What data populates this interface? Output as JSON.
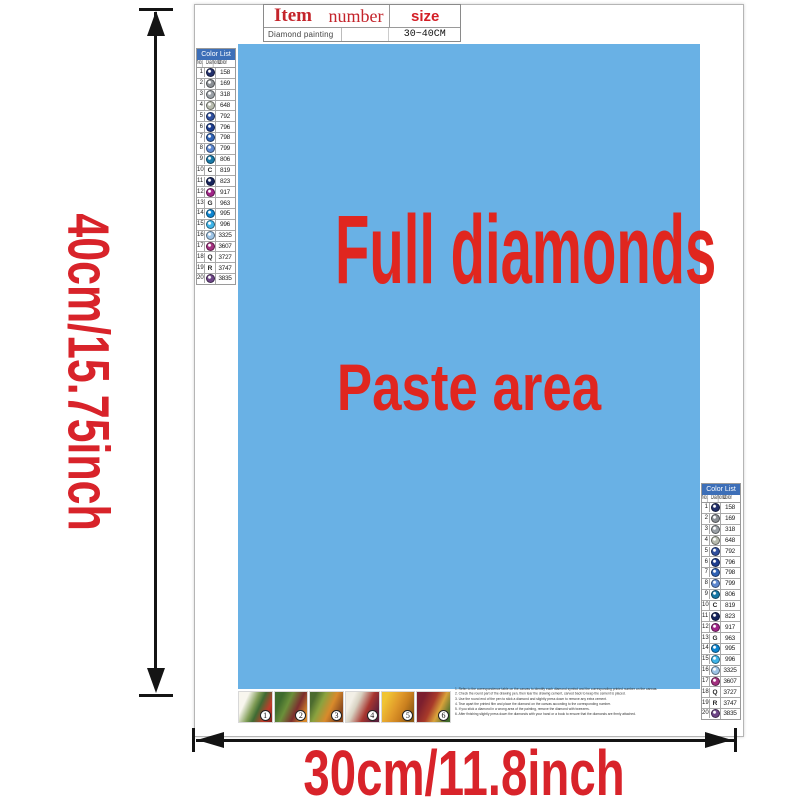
{
  "item_table": {
    "col1_header": "Item",
    "col2_header": "number",
    "col3_header": "size",
    "col1_value": "Diamond painting",
    "col2_value": "",
    "col3_value": "30~40CM"
  },
  "paste_area": {
    "line1": "Full diamonds",
    "line2": "Paste area",
    "bg_color": "#69b1e5",
    "text_color": "#e0261f"
  },
  "dimensions": {
    "height_label": "40cm/15.75inch",
    "width_label": "30cm/11.8inch",
    "label_color": "#d8232a"
  },
  "color_list": {
    "title": "Color List",
    "col_no": "No.",
    "col_diamond": "Diamond",
    "col_color": "Color",
    "header_bg": "#3d6fb8",
    "rows": [
      {
        "no": "1",
        "type": "circle",
        "color": "#23306b",
        "code": "158"
      },
      {
        "no": "2",
        "type": "circle",
        "color": "#8a8f94",
        "code": "169"
      },
      {
        "no": "3",
        "type": "circle",
        "color": "#9aa0a6",
        "code": "318"
      },
      {
        "no": "4",
        "type": "circle",
        "color": "#b7bbae",
        "code": "648"
      },
      {
        "no": "5",
        "type": "circle",
        "color": "#2f4f9e",
        "code": "792"
      },
      {
        "no": "6",
        "type": "circle",
        "color": "#1d3d8f",
        "code": "796"
      },
      {
        "no": "7",
        "type": "circle",
        "color": "#2f62b5",
        "code": "798"
      },
      {
        "no": "8",
        "type": "circle",
        "color": "#5d87cf",
        "code": "799"
      },
      {
        "no": "9",
        "type": "circle",
        "color": "#1779a8",
        "code": "806"
      },
      {
        "no": "10",
        "type": "letter",
        "symbol": "C",
        "code": "819"
      },
      {
        "no": "11",
        "type": "circle",
        "color": "#16245c",
        "code": "823"
      },
      {
        "no": "12",
        "type": "circle",
        "color": "#a12588",
        "code": "917"
      },
      {
        "no": "13",
        "type": "letter",
        "symbol": "G",
        "code": "963"
      },
      {
        "no": "14",
        "type": "circle",
        "color": "#0c85d0",
        "code": "995"
      },
      {
        "no": "15",
        "type": "circle",
        "color": "#3fb4e8",
        "code": "996"
      },
      {
        "no": "16",
        "type": "circle",
        "color": "#9cc3e5",
        "code": "3325"
      },
      {
        "no": "17",
        "type": "circle",
        "color": "#a3307f",
        "code": "3607"
      },
      {
        "no": "18",
        "type": "letter",
        "symbol": "Q",
        "code": "3727"
      },
      {
        "no": "19",
        "type": "letter",
        "symbol": "R",
        "code": "3747"
      },
      {
        "no": "20",
        "type": "circle",
        "color": "#6e4587",
        "code": "3835"
      }
    ]
  },
  "steps": [
    "1",
    "2",
    "3",
    "4",
    "5",
    "6"
  ],
  "instructions": [
    "1. Refer to the correspondence table on the canvas to identify each diamond symbol and the corresponding printed number on the canvas.",
    "2. Check the round part of the drawing pen, then tear the drawing cement, carved back to keep the cement is placed.",
    "3. Use the round end of the pen to stick a diamond and slightly press down to remove any extra cement.",
    "4. Tear apart the printed film and place the diamond on the canvas according to the corresponding number.",
    "5. If you stick a diamond in a wrong area of the painting, remove the diamond with tweezers.",
    "6. After finishing slightly press down the diamonds with your hand or a book to ensure that the diamonds are firmly attached."
  ]
}
